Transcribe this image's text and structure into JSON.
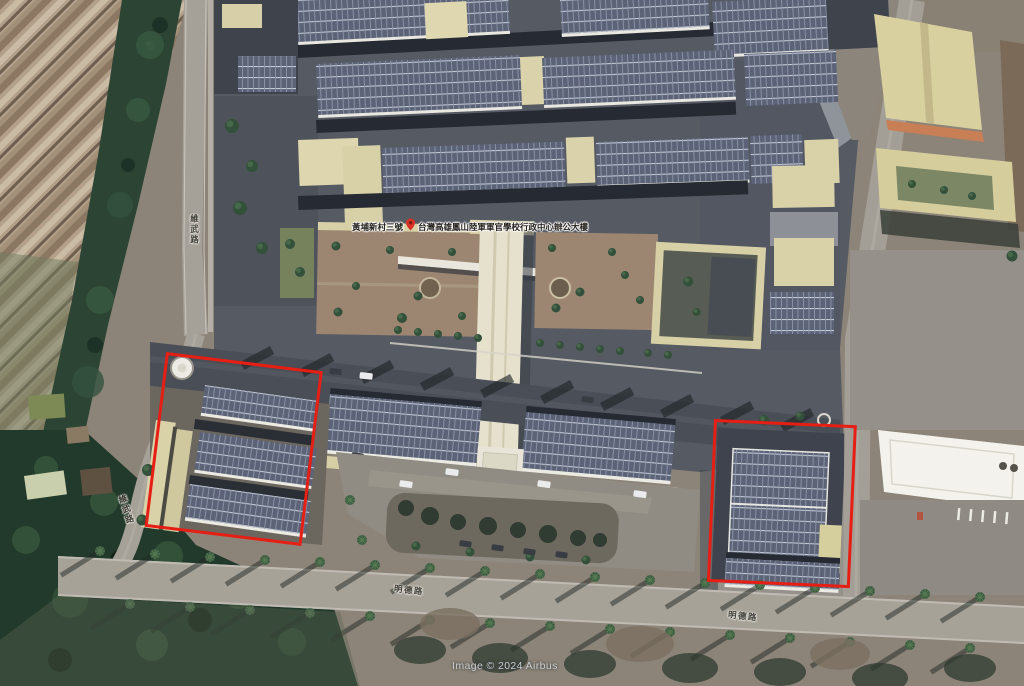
{
  "map": {
    "attribution": "Image © 2024 Airbus",
    "place_label": {
      "prefix": "黃埔新村三號",
      "name": "台灣高雄鳳山陸軍軍官學校行政中心辦公大樓"
    },
    "road_labels": [
      {
        "text": "維武路",
        "x": 190,
        "y": 214,
        "rotate": 0,
        "vertical": true
      },
      {
        "text": "維武路",
        "x": 122,
        "y": 494,
        "rotate": -18,
        "vertical": true
      },
      {
        "text": "明德路",
        "x": 394,
        "y": 586,
        "rotate": 6,
        "vertical": false
      },
      {
        "text": "明德路",
        "x": 728,
        "y": 612,
        "rotate": 6,
        "vertical": false
      }
    ],
    "annotations": [
      {
        "x": 166,
        "y": 352,
        "w": 158,
        "h": 176,
        "rotate": 7
      },
      {
        "x": 714,
        "y": 419,
        "w": 143,
        "h": 163,
        "rotate": 2.5
      }
    ],
    "colors": {
      "annotation": "#e61e14",
      "pin": "#d93025",
      "label_text": "#23201c",
      "watermark": "#c9ced2"
    }
  }
}
